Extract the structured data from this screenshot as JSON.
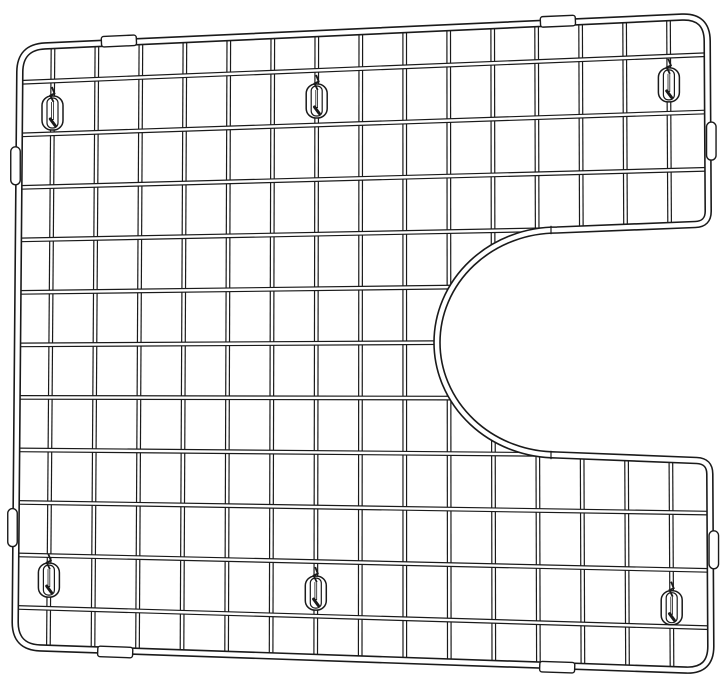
{
  "figure": {
    "title": "Wire sink bottom grid with right-side drain cutout - technical line drawing",
    "background_color": "#ffffff",
    "line_color": "#1a1a1a",
    "canvas": {
      "width": 724,
      "height": 692
    }
  },
  "grid": {
    "frame": {
      "corners": {
        "tl": [
          20,
          47
        ],
        "tr": [
          707,
          16
        ],
        "br": [
          711,
          671
        ],
        "bl": [
          15,
          647
        ]
      },
      "corner_radius": 25,
      "tube_outer": 7.6,
      "tube_inner": 4.4
    },
    "wires": {
      "vertical_count": 15,
      "vertical_u_start": 0.048,
      "vertical_u_step": 0.064,
      "horizontal_count": 11,
      "horizontal_v_start": 0.059,
      "horizontal_v_step": 0.0875,
      "tube_outer": 4.8,
      "tube_inner": 2.4
    },
    "cutout": {
      "inner_x": 557,
      "top_y": 230,
      "bottom_y": 455,
      "right_edge_top_y": 224,
      "right_edge_bottom_y": 461,
      "radius_x": 120,
      "radius_y": 112.5,
      "corner_radius": 13,
      "seam_x": 551
    },
    "feet": [
      {
        "u": 0.048,
        "v": 0.112
      },
      {
        "u": 0.432,
        "v": 0.108
      },
      {
        "u": 0.944,
        "v": 0.103
      },
      {
        "u": 0.048,
        "v": 0.887
      },
      {
        "u": 0.432,
        "v": 0.897
      },
      {
        "u": 0.944,
        "v": 0.905
      }
    ],
    "foot_size": {
      "w": 21,
      "h": 34
    },
    "tabs": [
      {
        "u": 0.144,
        "edge": "top"
      },
      {
        "u": 0.783,
        "edge": "top"
      },
      {
        "u": 0.144,
        "edge": "bottom"
      },
      {
        "u": 0.779,
        "edge": "bottom"
      }
    ],
    "tab_size": {
      "w": 35,
      "h": 10.5,
      "outset": 1.5
    },
    "bumpers": [
      {
        "edge": "left",
        "v": 0.198
      },
      {
        "edge": "left",
        "v": 0.801
      },
      {
        "edge": "right",
        "v": 0.191
      },
      {
        "edge": "right",
        "v": 0.815
      }
    ],
    "bumper_size": {
      "w": 9.5,
      "h": 38,
      "outset": 3.5
    }
  }
}
